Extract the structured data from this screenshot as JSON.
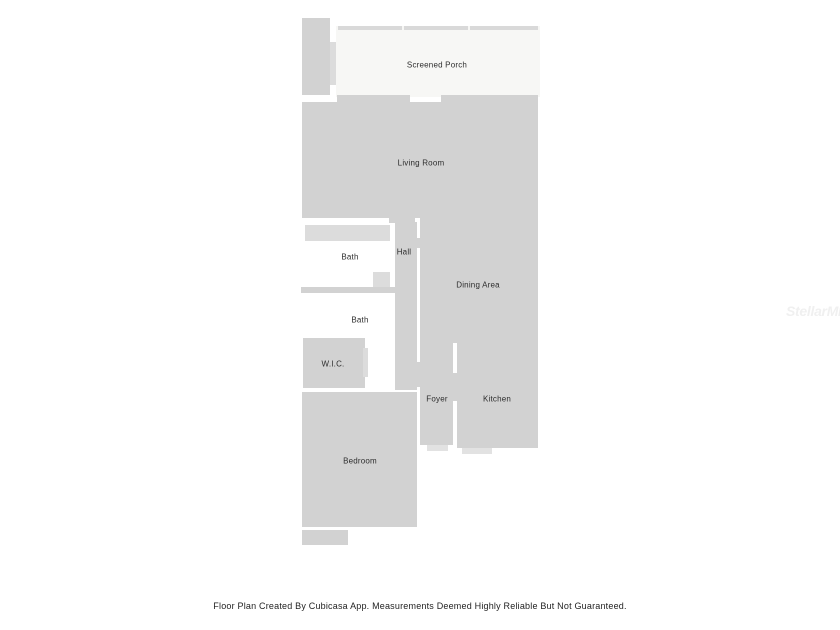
{
  "page": {
    "background": "#ffffff",
    "caption": "Floor Plan Created By Cubicasa App. Measurements Deemed Highly Reliable But Not Guaranteed.",
    "watermark": "StellarMLS"
  },
  "floorplan": {
    "colors": {
      "room": "#d2d2d2",
      "porch": "#f7f7f5",
      "fixture": "#dcdcdc",
      "screen": "#d9d9d9",
      "step": "#e2e2e2",
      "label_text": "#2d2d2d"
    },
    "shapes": [
      {
        "name": "porch-deck",
        "fill": "room",
        "x": 302,
        "y": 18,
        "w": 28,
        "h": 77
      },
      {
        "name": "porch-deck-door",
        "fill": "fixture",
        "x": 330,
        "y": 42,
        "w": 6,
        "h": 43
      },
      {
        "name": "screened-porch-floor",
        "fill": "porch",
        "x": 336,
        "y": 26,
        "w": 204,
        "h": 71
      },
      {
        "name": "porch-screen-segment-1",
        "fill": "screen",
        "x": 338,
        "y": 26,
        "w": 64,
        "h": 4
      },
      {
        "name": "porch-screen-segment-2",
        "fill": "screen",
        "x": 404,
        "y": 26,
        "w": 64,
        "h": 4
      },
      {
        "name": "porch-screen-segment-3",
        "fill": "screen",
        "x": 470,
        "y": 26,
        "w": 68,
        "h": 4
      },
      {
        "name": "porch-sill-left",
        "fill": "room",
        "x": 337,
        "y": 95,
        "w": 73,
        "h": 7
      },
      {
        "name": "porch-sill-right",
        "fill": "room",
        "x": 441,
        "y": 95,
        "w": 97,
        "h": 7
      },
      {
        "name": "living-room-floor",
        "fill": "room",
        "x": 302,
        "y": 102,
        "w": 236,
        "h": 116
      },
      {
        "name": "hall-top-bridge",
        "fill": "room",
        "x": 389,
        "y": 218,
        "w": 26,
        "h": 5
      },
      {
        "name": "dining-area-floor",
        "fill": "room",
        "x": 420,
        "y": 218,
        "w": 118,
        "h": 125
      },
      {
        "name": "hall-dining-door",
        "fill": "room",
        "x": 415,
        "y": 238,
        "w": 6,
        "h": 10
      },
      {
        "name": "hall-floor",
        "fill": "room",
        "x": 395,
        "y": 222,
        "w": 22,
        "h": 168
      },
      {
        "name": "bath1-tub",
        "fill": "fixture",
        "x": 305,
        "y": 225,
        "w": 85,
        "h": 16
      },
      {
        "name": "bath1-vanity",
        "fill": "fixture",
        "x": 373,
        "y": 272,
        "w": 17,
        "h": 15
      },
      {
        "name": "bath-divider-wall",
        "fill": "room",
        "x": 301,
        "y": 287,
        "w": 94,
        "h": 6
      },
      {
        "name": "wic-floor",
        "fill": "room",
        "x": 303,
        "y": 338,
        "w": 62,
        "h": 50
      },
      {
        "name": "wic-door",
        "fill": "fixture",
        "x": 363,
        "y": 348,
        "w": 5,
        "h": 29
      },
      {
        "name": "foyer-floor",
        "fill": "room",
        "x": 420,
        "y": 343,
        "w": 33,
        "h": 102
      },
      {
        "name": "hall-foyer-bridge",
        "fill": "room",
        "x": 415,
        "y": 362,
        "w": 7,
        "h": 25
      },
      {
        "name": "foyer-kitchen-door",
        "fill": "room",
        "x": 452,
        "y": 373,
        "w": 6,
        "h": 28
      },
      {
        "name": "kitchen-floor",
        "fill": "room",
        "x": 457,
        "y": 343,
        "w": 81,
        "h": 105
      },
      {
        "name": "foyer-step",
        "fill": "step",
        "x": 427,
        "y": 445,
        "w": 21,
        "h": 6
      },
      {
        "name": "kitchen-step",
        "fill": "step",
        "x": 462,
        "y": 448,
        "w": 30,
        "h": 6
      },
      {
        "name": "bedroom-floor",
        "fill": "room",
        "x": 302,
        "y": 392,
        "w": 115,
        "h": 135
      },
      {
        "name": "bedroom-step",
        "fill": "room",
        "x": 302,
        "y": 530,
        "w": 46,
        "h": 15
      }
    ],
    "labels": [
      {
        "name": "screened-porch",
        "text": "Screened Porch",
        "x": 437,
        "y": 65
      },
      {
        "name": "living-room",
        "text": "Living Room",
        "x": 421,
        "y": 163
      },
      {
        "name": "bath-upper",
        "text": "Bath",
        "x": 350,
        "y": 257
      },
      {
        "name": "hall",
        "text": "Hall",
        "x": 404,
        "y": 252
      },
      {
        "name": "bath-lower",
        "text": "Bath",
        "x": 360,
        "y": 320
      },
      {
        "name": "dining-area",
        "text": "Dining Area",
        "x": 478,
        "y": 285
      },
      {
        "name": "wic",
        "text": "W.I.C.",
        "x": 333,
        "y": 364
      },
      {
        "name": "foyer",
        "text": "Foyer",
        "x": 437,
        "y": 399
      },
      {
        "name": "kitchen",
        "text": "Kitchen",
        "x": 497,
        "y": 399
      },
      {
        "name": "bedroom",
        "text": "Bedroom",
        "x": 360,
        "y": 461
      }
    ]
  }
}
